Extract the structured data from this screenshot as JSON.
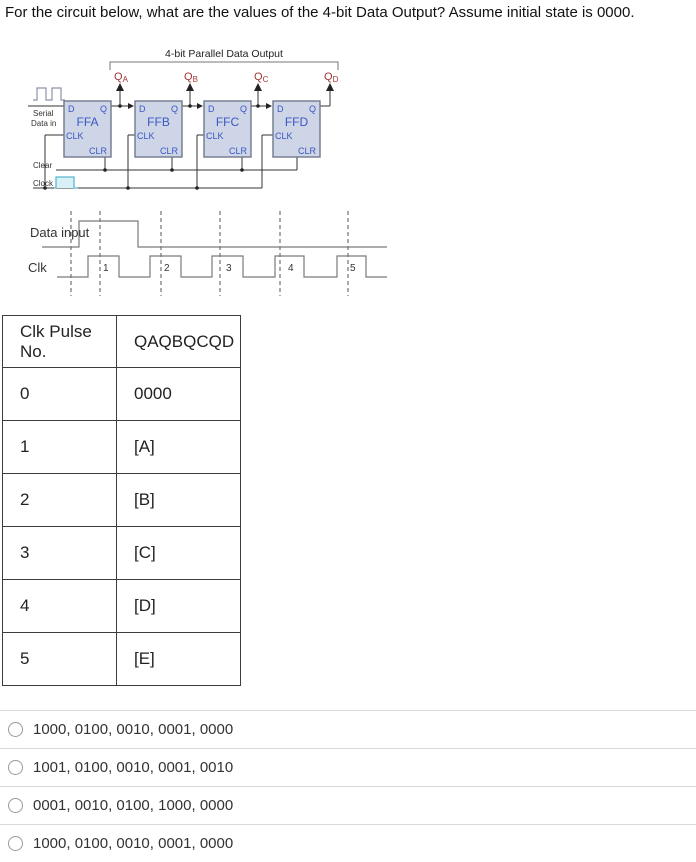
{
  "question": "For the circuit below, what are the values of the 4-bit Data Output? Assume initial state is 0000.",
  "circuit": {
    "title": "4-bit Parallel Data Output",
    "outputs": [
      {
        "q": "Q",
        "sub": "A"
      },
      {
        "q": "Q",
        "sub": "B"
      },
      {
        "q": "Q",
        "sub": "C"
      },
      {
        "q": "Q",
        "sub": "D"
      }
    ],
    "flipflops": [
      "FFA",
      "FFB",
      "FFC",
      "FFD"
    ],
    "pins": {
      "d": "D",
      "q": "Q",
      "clk": "CLK",
      "clr": "CLR"
    },
    "serial_label": [
      "Serial",
      "Data in"
    ],
    "clear_label": "Clear",
    "clock_label": "Clock",
    "colors": {
      "flipflop_fill": "#cdd5e6",
      "flipflop_border": "#70798c",
      "flipflop_text": "#3a57c4",
      "output_label": "#a03434",
      "clock_pulse": "#59b8d2",
      "wire": "#333333"
    }
  },
  "timing": {
    "data_label": "Data input",
    "clk_label": "Clk",
    "pulse_numbers": [
      "1",
      "2",
      "3",
      "4",
      "5"
    ]
  },
  "table": {
    "headers": [
      "Clk Pulse No.",
      "QAQBQCQD"
    ],
    "rows": [
      [
        "0",
        "0000"
      ],
      [
        "1",
        "[A]"
      ],
      [
        "2",
        "[B]"
      ],
      [
        "3",
        "[C]"
      ],
      [
        "4",
        "[D]"
      ],
      [
        "5",
        "[E]"
      ]
    ]
  },
  "options": [
    {
      "label": "1000, 0100, 0010, 0001, 0000"
    },
    {
      "label": "1001, 0100, 0010, 0001, 0010"
    },
    {
      "label": "0001, 0010, 0100, 1000, 0000"
    },
    {
      "label": "1000, 0100, 0010, 0001, 0000"
    }
  ]
}
